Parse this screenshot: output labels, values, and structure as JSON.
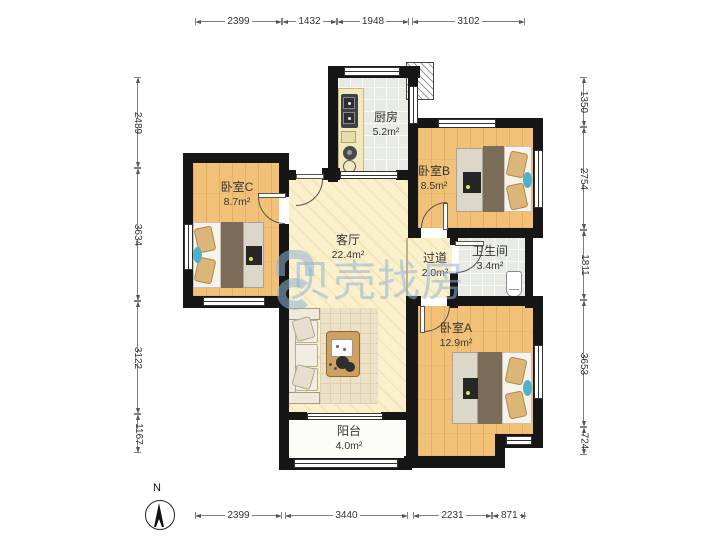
{
  "title": "apartment-floor-plan",
  "rooms": {
    "kitchen": {
      "name": "厨房",
      "area": "5.2m²"
    },
    "bedroom_b": {
      "name": "卧室B",
      "area": "8.5m²"
    },
    "bedroom_c": {
      "name": "卧室C",
      "area": "8.7m²"
    },
    "living": {
      "name": "客厅",
      "area": "22.4m²"
    },
    "hallway": {
      "name": "过道",
      "area": "2.0m²"
    },
    "bathroom": {
      "name": "卫生间",
      "area": "3.4m²"
    },
    "bedroom_a": {
      "name": "卧室A",
      "area": "12.9m²"
    },
    "balcony": {
      "name": "阳台",
      "area": "4.0m²"
    }
  },
  "dimensions": {
    "top": [
      "2399",
      "1432",
      "1948",
      "3102"
    ],
    "bottom": [
      "2399",
      "3440",
      "2231",
      "871"
    ],
    "left": [
      "2489",
      "3634",
      "3122",
      "1167"
    ],
    "right": [
      "1350",
      "2754",
      "1811",
      "3653",
      "724"
    ]
  },
  "compass": {
    "label": "N"
  },
  "watermark": {
    "text": "贝壳找房"
  },
  "colors": {
    "wall": "#161616",
    "wood_floor": "#f2c178",
    "tile_floor": "#e8eae6",
    "living_floor": "#faf0cb",
    "watermark_blue": "#8eb4d8",
    "teal_accent": "#4fb0c6",
    "blanket_brown": "#7b6b59"
  }
}
